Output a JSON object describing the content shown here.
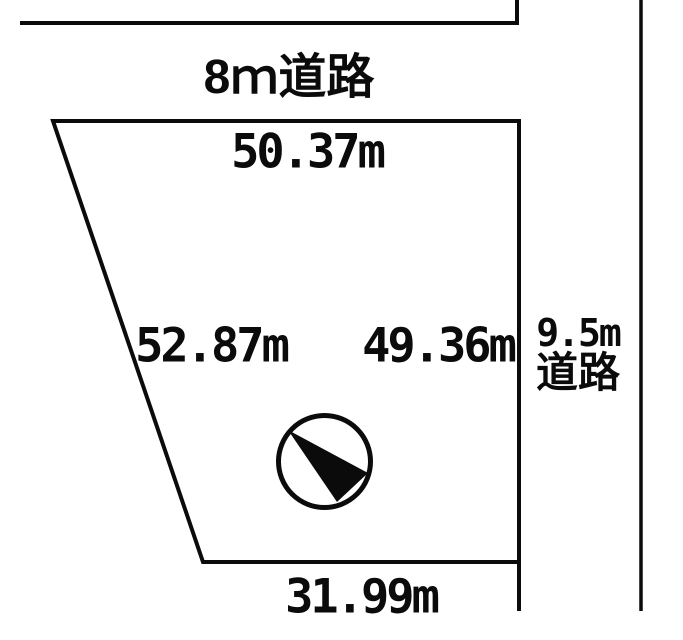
{
  "diagram": {
    "background_color": "#ffffff",
    "line_color": "#0b0b0b",
    "top_road": {
      "label": "8ｍ道路"
    },
    "side_road": {
      "width_label": "9.5m",
      "word_label": "道路"
    },
    "lot_dimensions": {
      "top": "50.37m",
      "left": "52.87m",
      "right": "49.36m",
      "bottom": "31.99m"
    },
    "compass": {
      "icon": "north-arrow-icon"
    }
  }
}
